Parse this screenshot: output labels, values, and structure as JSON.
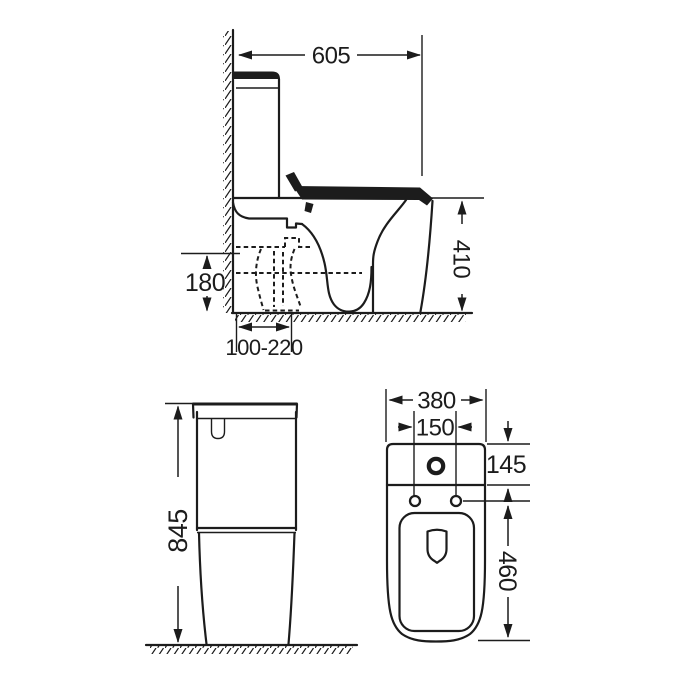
{
  "canvas": {
    "background": "#ffffff",
    "line_color": "#1c1c1c"
  },
  "dimensions": {
    "side_view": {
      "overall_depth": "605",
      "rim_height": "410",
      "outlet_height": "180",
      "outlet_setout_range": "100-220"
    },
    "front_view": {
      "overall_height": "845"
    },
    "plan_view": {
      "overall_width": "380",
      "fixing_centres": "150",
      "cistern_depth": "145",
      "pan_length": "460"
    }
  }
}
